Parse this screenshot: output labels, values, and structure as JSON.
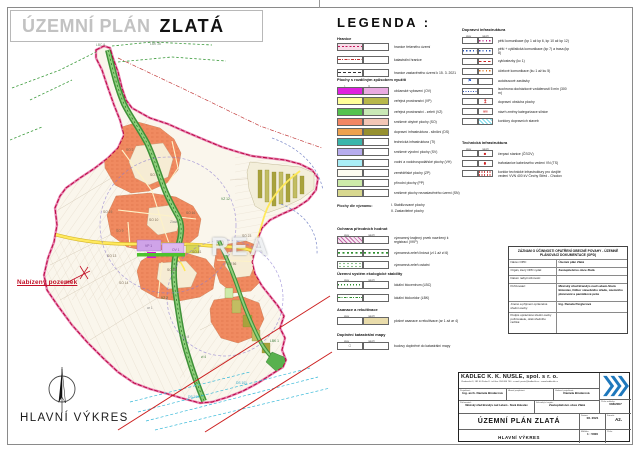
{
  "sheet": {
    "title_prefix": "ÚZEMNÍ PLÁN",
    "title_name": "ZLATÁ",
    "drawing_caption": "HLAVNÍ VÝKRES"
  },
  "map": {
    "watermark": "REA",
    "annotation": "Nabízený pozemek",
    "labels": [
      {
        "t": "LBC 9",
        "x": 96,
        "y": 46,
        "c": "#6a8a6a"
      },
      {
        "t": "LBK 36",
        "x": 150,
        "y": 45,
        "c": "#6a8a6a"
      },
      {
        "t": "SO 2",
        "x": 126,
        "y": 151
      },
      {
        "t": "SO 4",
        "x": 150,
        "y": 176
      },
      {
        "t": "SO 19",
        "x": 103,
        "y": 213
      },
      {
        "t": "SO 10",
        "x": 149,
        "y": 221
      },
      {
        "t": "SO 9",
        "x": 116,
        "y": 232
      },
      {
        "t": "Zlatá",
        "x": 170,
        "y": 223,
        "c": "#8a8a8a"
      },
      {
        "t": "SO 16",
        "x": 186,
        "y": 214
      },
      {
        "t": "VZ 12",
        "x": 221,
        "y": 200,
        "c": "#3a7a3a"
      },
      {
        "t": "SO 23",
        "x": 242,
        "y": 237
      },
      {
        "t": "SO 13",
        "x": 107,
        "y": 257
      },
      {
        "t": "SO 22",
        "x": 167,
        "y": 271
      },
      {
        "t": "SO 14",
        "x": 119,
        "y": 284
      },
      {
        "t": "VP 1",
        "x": 145,
        "y": 247,
        "c": "#7a4a9a"
      },
      {
        "t": "OV 1",
        "x": 172,
        "y": 251,
        "c": "#7a4a9a"
      },
      {
        "t": "SO 41",
        "x": 192,
        "y": 253
      },
      {
        "t": "SO 56",
        "x": 227,
        "y": 265
      },
      {
        "t": "VZ 2",
        "x": 161,
        "y": 299,
        "c": "#3a7a3a"
      },
      {
        "t": "ar 1",
        "x": 147,
        "y": 309,
        "c": "#888888"
      },
      {
        "t": "ko 8",
        "x": 183,
        "y": 338,
        "c": "#888888"
      },
      {
        "t": "zl 4",
        "x": 201,
        "y": 358,
        "c": "#3a7a3a"
      },
      {
        "t": "LBK 1",
        "x": 270,
        "y": 342,
        "c": "#3a7a3a"
      },
      {
        "t": "DS 101",
        "x": 188,
        "y": 398,
        "c": "#2aa7c7"
      },
      {
        "t": "DS 101",
        "x": 236,
        "y": 384,
        "c": "#2aa7c7"
      }
    ]
  },
  "legend": {
    "title": "LEGENDA :",
    "hranice": {
      "header": "Hranice",
      "items": [
        {
          "label": "hranice řešeného území",
          "s1": "pink-band"
        },
        {
          "label": "katastrální hranice",
          "s1": "red-dashdot"
        },
        {
          "label": "hranice zastavěného území k 15. 3. 2021",
          "s1": "black-dash"
        }
      ]
    },
    "plochy": {
      "header": "Plochy s rozdílným způsobem využití",
      "col1": "I.",
      "col2": "II.",
      "items": [
        {
          "label": "občanské vybavení (OV)",
          "c1": "#e020e0",
          "c2": "#eaaae2"
        },
        {
          "label": "veřejná prostranství (VP)",
          "c1": "#ffff99",
          "c2": "#b8b84a"
        },
        {
          "label": "veřejná prostranství - zeleň (VZ)",
          "c1": "#55c24e",
          "c2": "#c9e9b6"
        },
        {
          "label": "smíšené obytné plochy (SO)",
          "c1": "#f28563",
          "c2": "#f3c6b6"
        },
        {
          "label": "dopravní infrastruktura - silniční (DS)",
          "c1": "#eda14e",
          "c2": "#96902f"
        },
        {
          "label": "technická infrastruktura (TI)",
          "c1": "#3ab5ab",
          "c2": "#ffffff"
        },
        {
          "label": "smíšené výrobní plochy (SV)",
          "c1": "#b7acee",
          "c2": "#ffffff"
        },
        {
          "label": "vodní a vodohospodářské plochy (VH)",
          "c1": "#a9eef7",
          "c2": "#ffffff"
        },
        {
          "label": "zemědělské plochy (ZP)",
          "c1": "#fdfbf0",
          "c2": "#ffffff"
        },
        {
          "label": "přírodní plochy (PP)",
          "c1": "#cdeaa9",
          "c2": "#ffffff"
        },
        {
          "label": "smíšené plochy nezastavěného území (SN)",
          "c1": "#d8d88f",
          "c2": "#ffffff"
        }
      ]
    },
    "vyznam": {
      "header": "Plochy dle významu:",
      "items": [
        "I. Stabilizované plochy",
        "II. Zastavitelné plochy"
      ]
    },
    "ochrana": {
      "header": "Ochrana přírodních hodnot",
      "col_stav": "stav",
      "col_navrh": "návrh",
      "items": [
        {
          "label": "významný krajinný prvek navržený k registraci (VKP)",
          "s1": "vkp-hatch"
        },
        {
          "label": "významná zeleň liniová (zl 1 až zl 6)",
          "s1": "green-dashes",
          "s2": "green-dashes"
        },
        {
          "label": "významná zeleň ostatní",
          "s1": "green-sprigs"
        }
      ]
    },
    "uses": {
      "header": "Územní systém ekologické stability",
      "col_stav": "stav",
      "col_navrh": "návrh",
      "items": [
        {
          "label": "lokální biocentrum (LBC)",
          "s1": "green-dotline"
        },
        {
          "label": "lokální biokoridor (LBK)",
          "s1": "green-dashdot"
        }
      ]
    },
    "asanace": {
      "header": "Asanace a rekultivace",
      "col_stav": "stav",
      "col_navrh": "návrh",
      "items": [
        {
          "label": "plošné asanace a rekultivace (ar 1 až ar 4)",
          "s2": "tan-fill"
        }
      ]
    },
    "doplneni": {
      "header": "Doplnění katastrální mapy",
      "col_stav": "stav",
      "col_navrh": "návrh",
      "items": [
        {
          "label": "budovy doplněné do katastrální mapy",
          "s1": "building"
        }
      ]
    },
    "doprava": {
      "header": "Dopravní infrastruktura",
      "col_stav": "stav",
      "col_navrh": "návrh",
      "items": [
        {
          "label": "pěší komunikace (kp 1 až kp 6, kp 10 až kp 12)",
          "s2": "magenta-dots"
        },
        {
          "label": "pěší + cyklistická komunikace (kp 7) a trasa (kp 8)",
          "s1": "blue-dots",
          "s2": "blue-dots"
        },
        {
          "label": "cyklostezky (kc 1)",
          "s2": "red-dash"
        },
        {
          "label": "účelové komunikace (ku 1 až ku 5)",
          "s2": "orange-dots"
        },
        {
          "label": "autobusové zastávky",
          "s1": "bus"
        },
        {
          "label": "isochrona docházkové vzdálenosti 5 min (300 m)",
          "s1": "blue-dotline"
        },
        {
          "label": "dopravní obsluha plochy",
          "s2": "red-arrow"
        },
        {
          "label": "návrh změny kategorizace silnice",
          "s2": "cat-text"
        },
        {
          "label": "koridory dopravních staveb",
          "s2": "cyan-hatch"
        }
      ]
    },
    "technika": {
      "header": "Technická infrastruktura",
      "col_stav": "stav",
      "col_navrh": "návrh",
      "items": [
        {
          "label": "čerpací stanice (ČSOV)",
          "s2": "red-sq"
        },
        {
          "label": "trafostanice kabelového vedení VN (TS)",
          "s2": "red-dot"
        },
        {
          "label": "koridor technické infrastruktury pro dvojité vedení VVN 400 kV Čechy Střed - Chodov",
          "s2": "red-hatch-corridor"
        }
      ]
    }
  },
  "zaznam": {
    "title": "ZÁZNAM O ÚČINNOSTI OPATŘENÍ OBECNÉ POVAHY - ÚZEMNĚ PLÁNOVACÍ DOKUMENTACE (OPD)",
    "rows": [
      {
        "label": "Název OPD:",
        "value": "Územní plán Zlatá"
      },
      {
        "label": "Orgán, který OPD vydal:",
        "value": "Zastupitelstvo obce Zlatá"
      },
      {
        "label": "Datum nabytí účinnosti:",
        "value": ""
      },
      {
        "label": "Pořizovatel:",
        "value": "Městský úřad Brandýs nad Labem-Stará Boleslav, Odbor stavebního úřadu, územního plánování a památkové péče"
      },
      {
        "label": "Jméno a příjmení oprávněné úřední osoby:",
        "value": "Ing. Renata Perglerová"
      },
      {
        "label": "Podpis oprávněné úřední osoby pořizovatele, otisk úředního razítka:",
        "value": ""
      }
    ]
  },
  "titleblock": {
    "company": "KADLEC K. K. NUSLE, spol. s r. o.",
    "company_info": "Chaberská 3, 182 00 Praha 8 · tel./fax: 284 680 740 · e-mail: posta@kadleckk.cz · www.kadleckk.cz",
    "projektant_label": "Projektant:",
    "projektant_value": "Ing. arch. Daniela Binderová",
    "hlavni_label": "Hlavní projektant:",
    "hlavni_value": "",
    "vedouci_label": "Vedoucí projektant:",
    "vedouci_value": "Daniela Binderová",
    "porizovatel_label": "Pořizovatel:",
    "porizovatel_value": "Městský úřad Brandýs nad Labem - Stará Boleslav",
    "schvalujici_label": "Schvalující orgán:",
    "schvalujici_value": "Zastupitelstvo obce Zlatá",
    "zakazka_label": "Číslo zakázky:",
    "zakazka_value": "036/2007",
    "doc_title": "ÚZEMNÍ PLÁN ZLATÁ",
    "datum_label": "Datum:",
    "datum_value": "06. 2021",
    "format_label": "Formát:",
    "format_value": "A2.",
    "vykres": "HLAVNÍ VÝKRES",
    "meritko_label": "Měřítko:",
    "meritko_value": "1 : 5000",
    "cislo_label": "Číslo:",
    "cislo_value": ""
  },
  "colors": {
    "annotation_red": "#c21027",
    "boundary_pink": "#e87fae",
    "boundary_red": "#b5003c",
    "road_yellow": "#ffe95c",
    "greenway_green": "#3f9138",
    "residential_orange": "#f08a60"
  }
}
